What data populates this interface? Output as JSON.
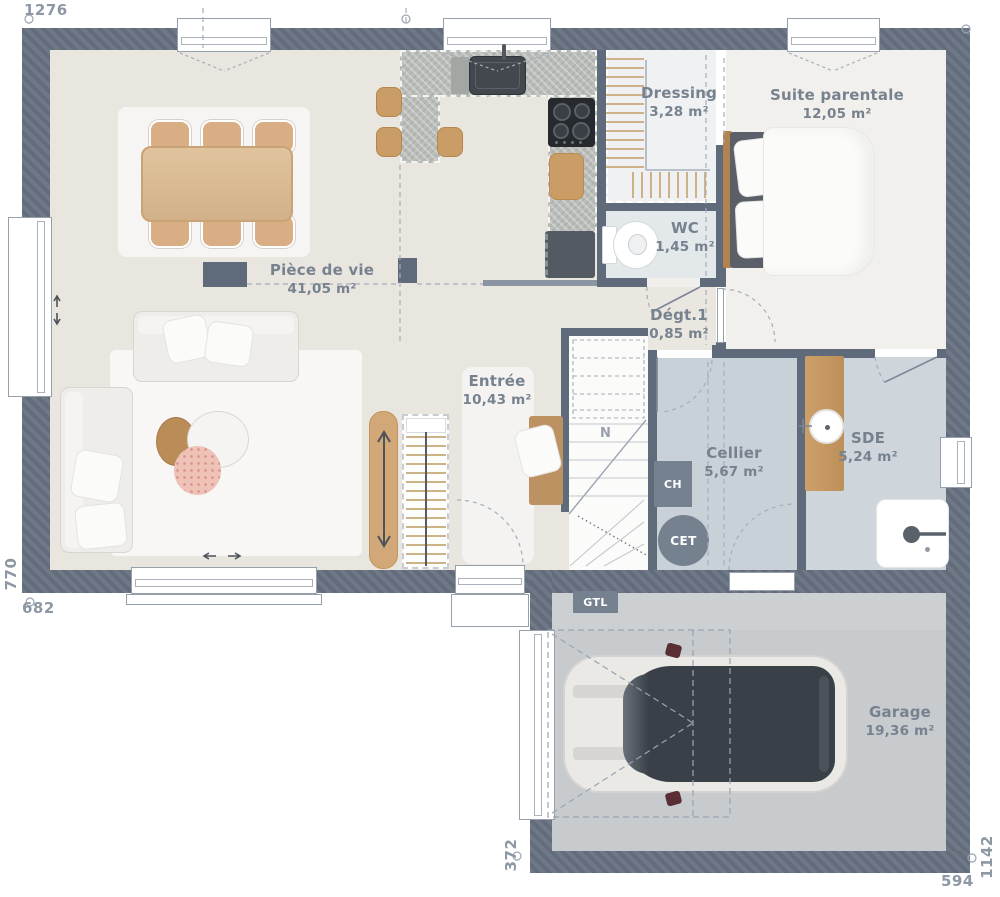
{
  "plan_title": "Plan de rez-de-chaussée",
  "dimensions": {
    "top": "1276",
    "left": "770",
    "bottom_left": "682",
    "garage_left": "372",
    "garage_right": "1142",
    "garage_bottom": "594"
  },
  "rooms": {
    "piece_de_vie": {
      "name": "Pièce de vie",
      "area": "41,05 m²"
    },
    "entree": {
      "name": "Entrée",
      "area": "10,43 m²"
    },
    "dressing": {
      "name": "Dressing",
      "area": "3,28 m²"
    },
    "suite_parentale": {
      "name": "Suite parentale",
      "area": "12,05 m²"
    },
    "wc": {
      "name": "WC",
      "area": "1,45 m²"
    },
    "degagement": {
      "name": "Dégt.1",
      "area": "0,85 m²"
    },
    "cellier": {
      "name": "Cellier",
      "area": "5,67 m²"
    },
    "sde": {
      "name": "SDE",
      "area": "5,24 m²"
    },
    "garage": {
      "name": "Garage",
      "area": "19,36 m²"
    }
  },
  "equipment": {
    "boiler": "CH",
    "water_heater": "CET",
    "electrical_trunk": "GTL",
    "stairs_mark": "N"
  },
  "colors": {
    "wall": "#6e7887",
    "floor_living": "#e9e5df",
    "floor_suite": "#f2f0ec",
    "floor_technical": "#c8d1d8",
    "wood_accent": "#cb9d66",
    "label_text": "#77828f"
  }
}
